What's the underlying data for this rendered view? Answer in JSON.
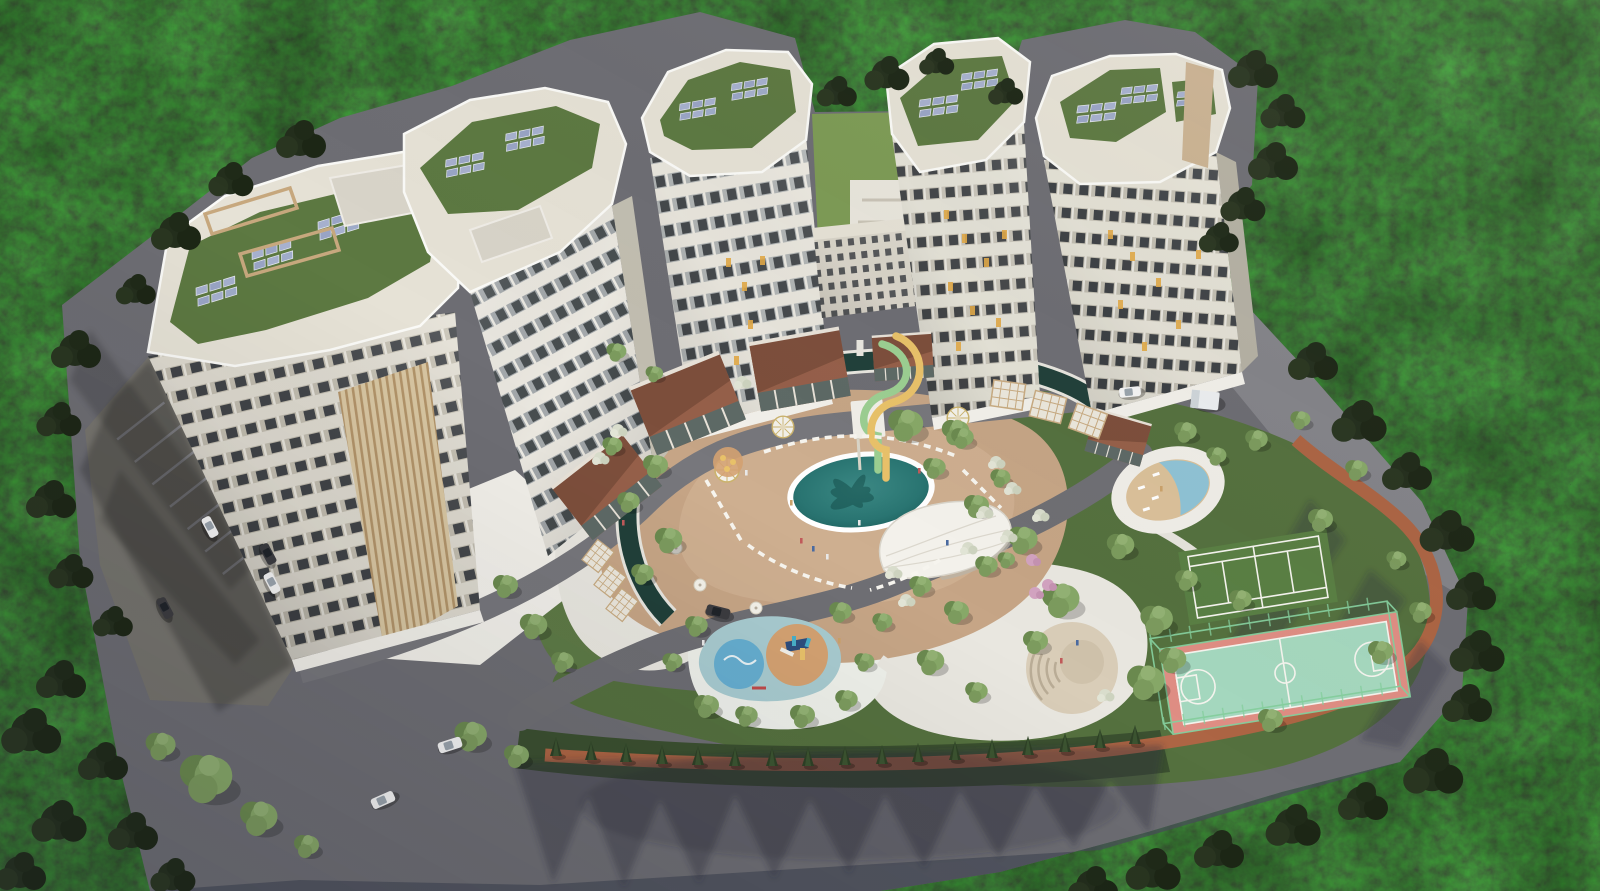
{
  "meta": {
    "title": "Aerial architectural rendering of a residential complex in a forest",
    "view": "bird's-eye 3D visualization, daylight",
    "site": {
      "towers_visible": 6,
      "water_slides": 2,
      "cafes_pavilions": 5,
      "pergola_cabanas": 6,
      "gazebos": 3,
      "cars_visible": 9,
      "sports_courts": 2
    }
  },
  "labels": {
    "scene": "Aerial view of a curved residential high-rise complex with resort courtyard surrounded by dense forest",
    "forest": "Dense pine forest surrounding the site",
    "ground": "Asphalt roads and site ground",
    "parking": "Parking lot with marked stalls",
    "entrancePlaza": "White entrance plaza",
    "ringRoad": "Inner ring road along the towers",
    "innerRoad": "Internal courtyard road",
    "towerA": "Apartment tower with timber-slat facade and green solar roof",
    "towerB": "Curved apartment tower wing",
    "towerC": "Central apartment tower slab",
    "lowBlock": "Low connecting residential block",
    "courtyardLawn": "Private lawn courtyard between towers",
    "towerE": "Right apartment tower (west slab)",
    "towerF": "Right apartment tower (east slab)",
    "solar": "Rooftop photovoltaic panel array on green roof",
    "pergolaFrame": "Rooftop pergola frame",
    "cafes": "Brick cafe pavilions along the lazy river",
    "pergolas": "White lattice pergola cabanas",
    "gazebo": "Round glass gazebo",
    "lazyRiver": "Dark lazy-river canal looping around the pool deck",
    "sunDeck": "Tan sun deck around the main pool",
    "mainPool": "Oval swimming pool with lotus mosaic",
    "slides": "Intertwined yellow and green water slides",
    "eventCanopy": "Leaf-shaped white event canopy",
    "loungers": "Rows of white sun loungers",
    "kidsCircle": "Kids splash circle with umbrellas",
    "playground": "Children's playground with rubber surface and slide",
    "amphitheatre": "Circular amphitheatre plaza with steps",
    "sandPool": "Round leisure pool with sand beach",
    "tennis": "Grass tennis court",
    "basketball": "Mint basketball court with pink apron and fence",
    "joggingPath": "Terracotta jogging path",
    "hedgerow": "Clipped hedgerow with cypress trees",
    "parkGreen": "Landscaped park greenery",
    "trees": "Ornamental trees and shrubs",
    "shadows": "Long afternoon shadows on the roads",
    "cars": "Cars on the access roads",
    "van": "White utility van",
    "people": "Tiny figures of residents"
  },
  "palette": {
    "forest": "#27301f",
    "forestDark": "#161d11",
    "road": "#6e6e74",
    "roadLight": "#8a8a8e",
    "roadShadow": "#4a4e5a",
    "plaza": "#e9e7e0",
    "plazaBright": "#f2f0ea",
    "deck": "#c6a586",
    "lawn": "#7d9b55",
    "green": "#55713f",
    "hedge": "#3b5030",
    "terracotta": "#ad6544",
    "canal": "#21403a",
    "poolWater": "#2e7d79",
    "poolDeep": "#1c5a57",
    "kidsRubber": "#a8cbd0",
    "kidsWater": "#66aed0",
    "kidsSand": "#d4a272",
    "sandBeach": "#dbc19a",
    "sandWater": "#8fc3d6",
    "courtMint": "#a5d8bf",
    "courtPink": "#df8e84",
    "courtFence": "#86cf9e",
    "tennisGreen": "#5a7f44",
    "amphiTan": "#d9cdb8",
    "facade": "#efece3",
    "facadeShade": "#c9c5b9",
    "windowDark": "#41464a",
    "windowLit": "#e2aa48",
    "roofCream": "#e6e2d6",
    "roofGreen": "#5d7942",
    "solarPanel": "#a7b1cf",
    "slatWood": "#d8c6a2",
    "brick": "#96604a",
    "brickRoof": "#7d4f3c",
    "canopyWhite": "#f4f2ec",
    "slideYellow": "#e9c26a",
    "slideGreen": "#9ccf92",
    "treeLight": "#87a868",
    "treeMid": "#6b8a4f",
    "bushWhite": "#d9ddcc",
    "bushPink": "#d2a3c0",
    "carWhite": "#f4f4f4",
    "carDark": "#3c3c40"
  }
}
